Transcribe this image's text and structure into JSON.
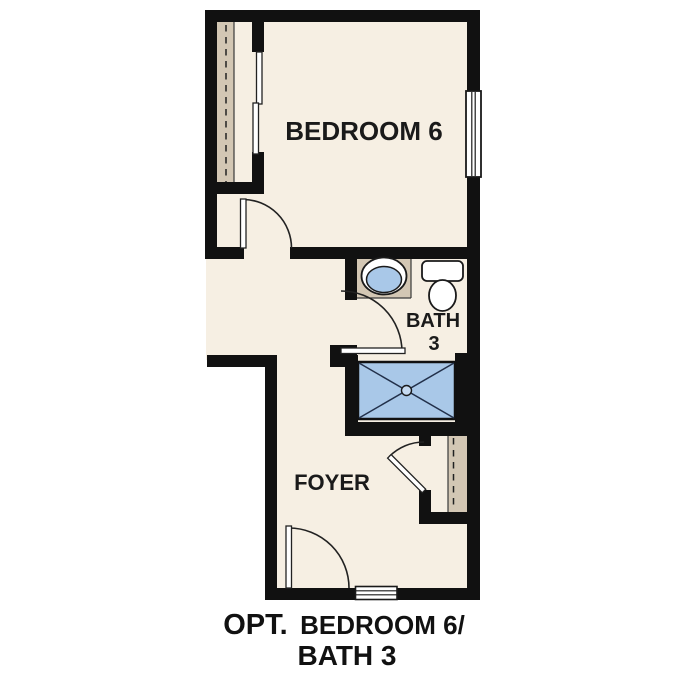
{
  "rooms": {
    "bedroom": {
      "label": "BEDROOM 6"
    },
    "bath": {
      "label_line1": "BATH",
      "label_line2": "3"
    },
    "foyer": {
      "label": "FOYER"
    }
  },
  "caption": {
    "line1_prefix": "OPT.",
    "line1_suffix": "BEDROOM 6/",
    "line2": "BATH 3"
  },
  "fixtures": {
    "icons": [
      "sink-icon",
      "toilet-icon",
      "shower-icon",
      "window-icon",
      "threshold-icon",
      "door-swing-icon",
      "bypass-doors-icon",
      "closet-rod-icon"
    ]
  },
  "colors": {
    "background": "#ffffff",
    "wall": "#111111",
    "floor": "#f6efe3",
    "closet_shelf": "#d3c7b4",
    "fixture_blue": "#a9c8e8",
    "outline": "#1a1a1a",
    "text": "#1a1a1a"
  }
}
